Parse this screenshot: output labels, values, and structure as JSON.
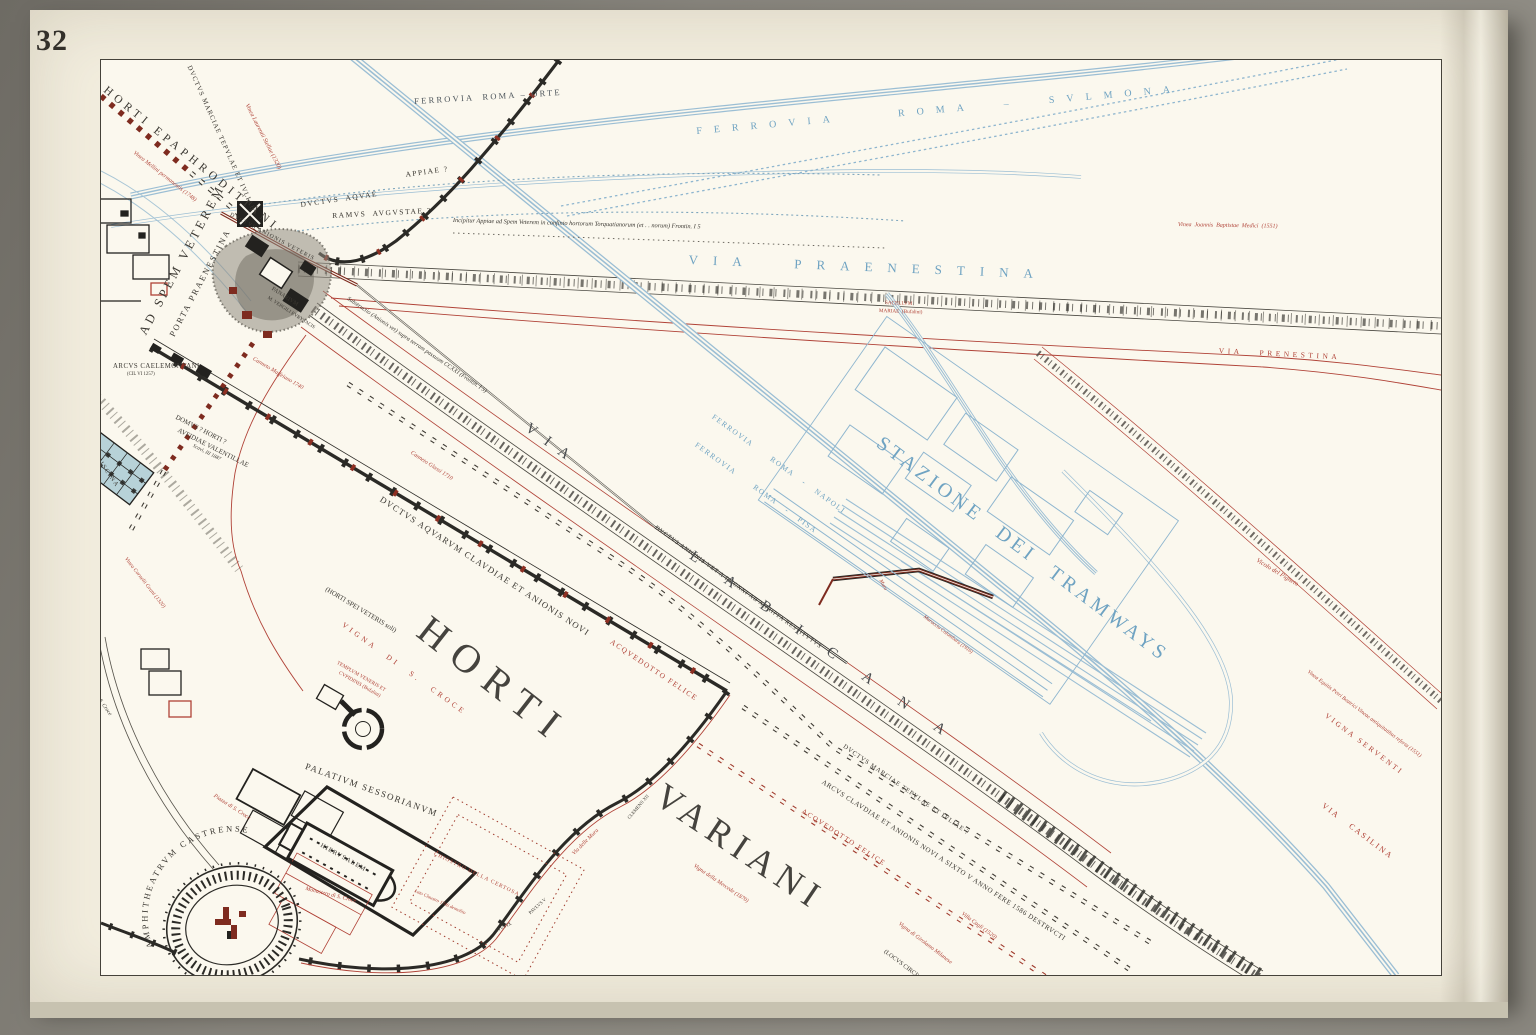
{
  "page_number": "32",
  "palette": {
    "paper": "#f2edde",
    "map_background": "#fbf8ee",
    "ink": "#3b3832",
    "wall_black": "#2b2a26",
    "antique_red": "#b04237",
    "maroon": "#7e2b1f",
    "railway_blue": "#9bbed4",
    "label_blue": "#6fa3c2"
  },
  "labels": {
    "ferrovia_roma_orte": "FERROVIA  ROMA – ORTE",
    "ferrovia_roma_sulmona": "FERROVIA  ROMA – SVLMONA",
    "ferrovia_roma_napoli": "FERROVIA  ROMA - NAPOLI",
    "ferrovia_roma_pisa": "FERROVIA  ROMA - PISA",
    "via_praenestina": "VIA PRAENESTINA",
    "via_prenestina_red": "VIA PRENESTINA",
    "vinea_joannis": "Vinea  Joannis  Baptistae  Medici  (1551)",
    "sacellum_line1": "SACELLVM",
    "sacellum_line2": "MARIAE  (Bufalini)",
    "incipit_note": "Incipitur Appiae ad Spem Veterem in confinio hortorum Torquatianorum (et . . norum) Frontin. I 5",
    "ductus_aquae": "DVCTVS  AQVAE",
    "appiae": "APPIAE ?",
    "ramus_augustae": "RAMVS  AVGVSTAE ?",
    "horti_epaphroditiani": "HORTI EPAPHRODITIANI",
    "ductus_marciae_wall": "DVCTVS MARCIAE TEPVLAE ET IVLIAE",
    "ad_spem_veterem": "AD SPEM VETEREM",
    "porta_praenestina": "PORTA PRAENESTINA",
    "vinea_laurentii": "Vinea Laurentii Stellae (1320)",
    "vinea_mellini": "Vinea Mellini permanentis (1748)",
    "ductus_anionis_veteris": "DVCTVS ANIONIS VETERIS",
    "panarium_line1": "PANARIVM",
    "panarium_line2": "M. VERGILI EVRYSACIS",
    "substructio_note": "Substructio (Anionis vet) supra terram passuum CCXXI (Frontin. I 5)",
    "arcus_caelemontani": "ARCVS CAELEMONTANI",
    "arcus_caelemontani_ref": "(CIL VI 1257)",
    "domus_line1": "DOMVS ? HORTI ?",
    "domus_line2": "AVFIDIAE VALENTILLAE",
    "domus_line3": "Scavi, III 1887",
    "piscina": "PISCINA",
    "canneto_maffeiano": "Canneto Maffeiano 1740",
    "canneto_glassi": "Canneto Glassi 1710",
    "vinea_cornelii": "Vinea Cornelii Grani (1320)",
    "via_di_s_croce": "Via di S. Croce",
    "ductus_aquarum_claudiae": "DVCTVS AQVARVM CLAVDIAE ET ANIONIS NOVI",
    "acquedotto_felice_upper": "ACQVEDOTTO FELICE",
    "horti_spei_veteris": "(HORTI SPEI VETERIS soli)",
    "vigna_di_s_croce": "VIGNA DI S. CROCE",
    "templum_line1": "TEMPLVM VENERIS ET",
    "templum_line2": "CVPIDINIS (Bufalini)",
    "horti_big": "HORTI",
    "variani_big": "VARIANI",
    "via_labicana_via": "VIA",
    "via_labicana_name": "LABICANA",
    "ductus_anionis_restitutus": "DVCTVS ANIONIS VET A DCCXXI AB AGRIPPA RESTITVTVS",
    "stazione_tramways": "STAZIONE DEI TRAMWAYS",
    "muro": "Muro",
    "muraccio_colombara": "Muraccio Colombara (1916)",
    "vicolo_del_pigneto": "Vicolo del Pigneto",
    "vinea_equitis": "Vinea Equitis Petri Beatrici Vineae antiquitatibus referta (1551)",
    "vigna_serventi": "VIGNA SERVENTI",
    "via_casilina": "VIA CASILINA",
    "palatium_sessorianum": "PALATIVM SESSORIANVM",
    "hierusalem": "HIERVSALEM",
    "amphitheatrum": "AMPHITHEATRVM CASTRENSE",
    "piazza_s_croce": "Piazza di S. Croce",
    "monastero_s_croce": "Monastero di S. Croce",
    "chiostro_certosa": "CHIOSTRO DELLA CERTOSA",
    "lato_claustro": "Lato Claustro 1746 demolito",
    "via_delle_mura": "Via delle Mura",
    "clemens_xii": "CLEMENS XII",
    "pius_ix": "PIVS IX",
    "paulus_v": "PAVLVS V",
    "ductus_marciae_q": "DVCTVS MARCIAE TEPVLAE ET IVLIAE ?",
    "arcus_claudiae_destructi": "ARCVS CLAVDIAE ET ANIONIS NOVI A SIXTO V ANNO FERE 1586 DESTRVCTI",
    "acquedotto_felice_lower": "ACQVEDOTTO FELICE",
    "vigna_mercede": "Vigna della Mercede (1870)",
    "villa_cagli": "Villa Cagli (1520)",
    "vigna_girolamo": "Vigna di Girolamo Milanese",
    "locus_circi": "(LOCVS CIRCI)"
  }
}
